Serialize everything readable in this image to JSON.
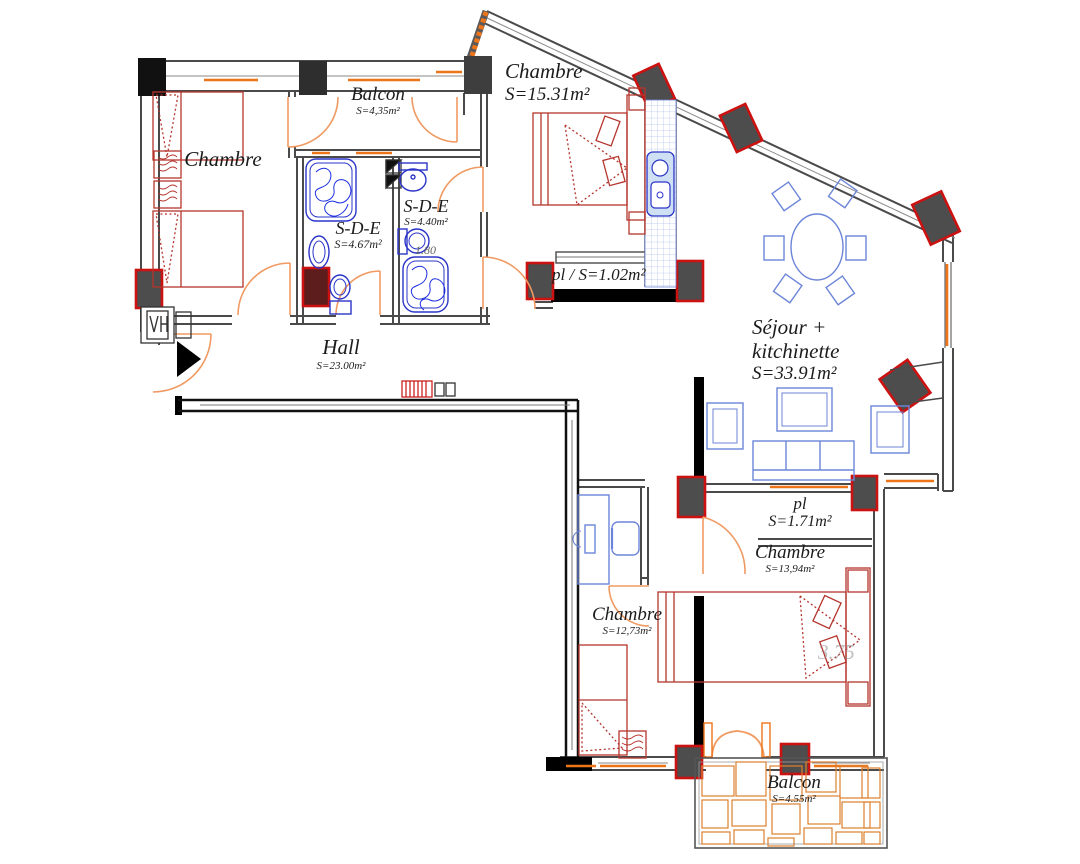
{
  "title": "Apartment floor plan",
  "rooms": [
    {
      "name": "Chambre",
      "area": ""
    },
    {
      "name": "Balcon",
      "area": "S=4,35m²"
    },
    {
      "name": "Chambre",
      "area": "S=15.31m²"
    },
    {
      "name": "S-D-E",
      "area": "S=4.67m²"
    },
    {
      "name": "S-D-E",
      "area": "S=4.40m²"
    },
    {
      "name": "pl / S=1.02m²",
      "area": ""
    },
    {
      "name": "Séjour + kitchinette",
      "area": "S=33.91m²"
    },
    {
      "name": "Hall",
      "area": "S=23.00m²"
    },
    {
      "name": "pl",
      "area": "S=1.71m²"
    },
    {
      "name": "Chambre",
      "area": "S=13,94m²"
    },
    {
      "name": "Chambre",
      "area": "S=12,73m²"
    },
    {
      "name": "Balcon",
      "area": "S=4.55m²"
    }
  ],
  "dimensions": [
    {
      "label": "1.80"
    },
    {
      "label": "3.75"
    }
  ],
  "colors": {
    "wall": "#4a4a4a",
    "black_wall": "#000000",
    "column_fill": "#4d4d4d",
    "column_outline": "#cc1111",
    "door_arc": "#f09a62",
    "window_sill": "#ee7418",
    "sanitary_blue": "#2b35c8",
    "furniture_red": "#b5352e",
    "furniture_blue": "#6c85d8",
    "paving_orange": "#dd8030"
  }
}
